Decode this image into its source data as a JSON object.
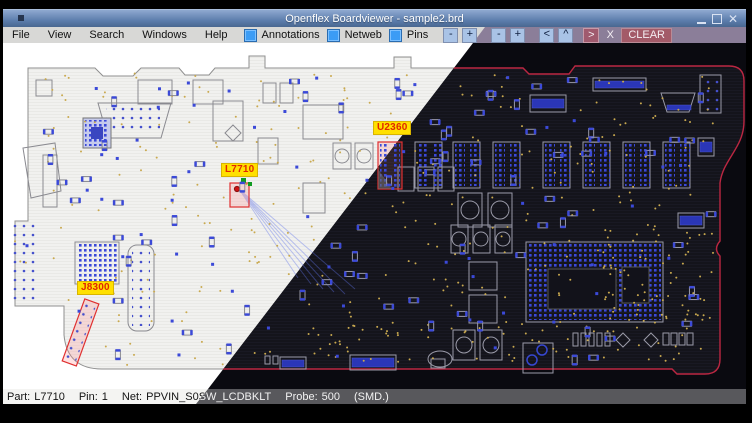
{
  "window": {
    "title": "Openflex Boardviewer - sample2.brd"
  },
  "menu": {
    "items": [
      {
        "label": "File"
      },
      {
        "label": "View"
      },
      {
        "label": "Search"
      },
      {
        "label": "Windows"
      },
      {
        "label": "Help"
      }
    ],
    "toggles": [
      {
        "label": "Annotations",
        "checked": true
      },
      {
        "label": "Netweb",
        "checked": true
      },
      {
        "label": "Pins",
        "checked": true
      }
    ],
    "light_buttons": [
      {
        "label": "-"
      },
      {
        "label": "+"
      },
      {
        "label": "-"
      },
      {
        "label": "+"
      },
      {
        "label": "<"
      },
      {
        "label": "^"
      }
    ],
    "dark_buttons": [
      {
        "label": ">"
      },
      {
        "label": "X"
      },
      {
        "label": "CLEAR"
      }
    ]
  },
  "board": {
    "labels": [
      {
        "ref": "U2360"
      },
      {
        "ref": "L7710"
      },
      {
        "ref": "J8300"
      }
    ]
  },
  "status": {
    "part_label": "Part:",
    "part": "L7710",
    "pin_label": "Pin:",
    "pin": "1",
    "net_label": "Net:",
    "net": "PPVIN_S0SW_LCDBKLT",
    "probe_label": "Probe:",
    "probe": "500",
    "mount": "(SMD.)"
  },
  "colors": {
    "titlebar_blue": "#5b7cab",
    "menubar_light": "#d8d8d6",
    "menubar_dark_mauve": "#8b7e99",
    "checkbox_blue": "#3b9cf5",
    "pad_blue": "#3b49d8",
    "via_gold": "#c9a94f",
    "highlight_red": "#e03030",
    "label_yellow": "#ffe000",
    "label_text_red": "#e02800",
    "board_outline_dark": "#bb2742",
    "status_dark_gray": "#58585c"
  }
}
